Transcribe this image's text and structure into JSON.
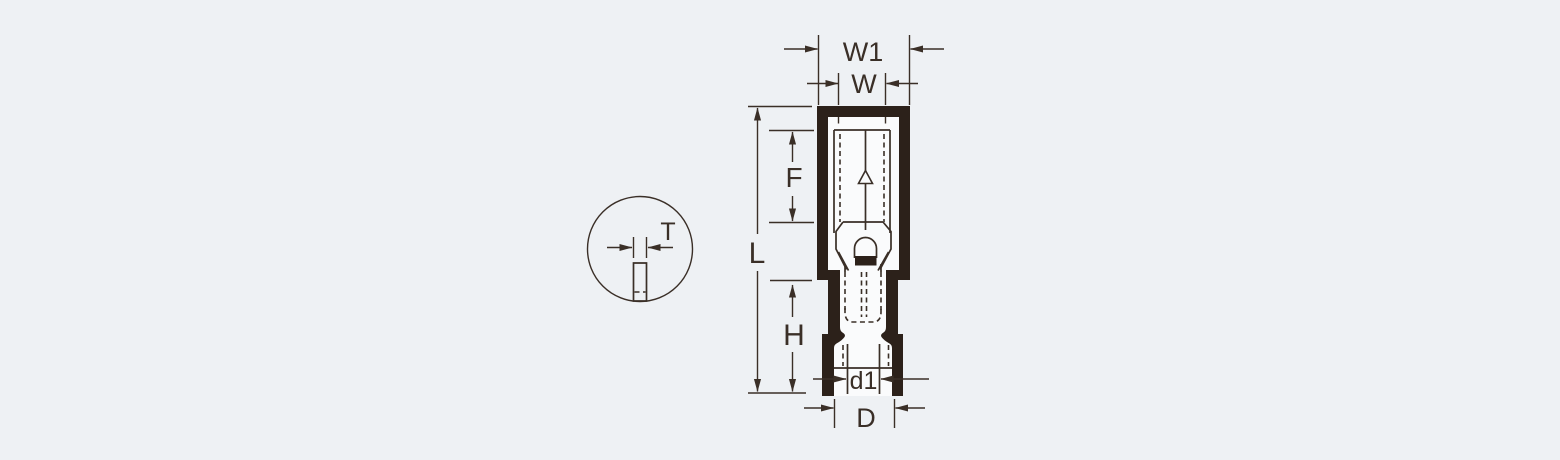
{
  "drawing": {
    "description_visible_text_only": "",
    "main_view": {
      "labels": {
        "w1": "W1",
        "w": "W",
        "l": "L",
        "f": "F",
        "h": "H",
        "d1": "d1",
        "d": "D"
      }
    },
    "detail_view": {
      "labels": {
        "t": "T"
      }
    }
  },
  "colors": {
    "background": "#eef1f4",
    "line_dark": "#2c211a",
    "line_thin": "#3a2f27",
    "cavity": "#fafbfc"
  }
}
